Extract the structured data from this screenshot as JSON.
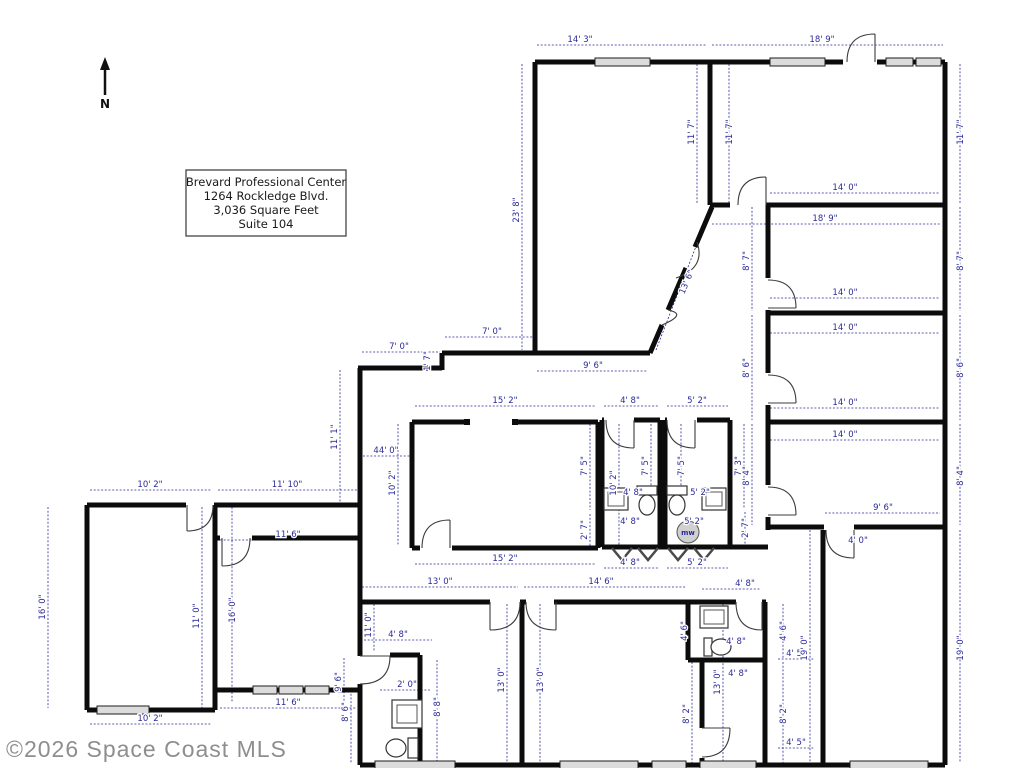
{
  "title_block": {
    "line1": "Brevard Professional Center",
    "line2": "1264 Rockledge Blvd.",
    "line3": "3,036 Square Feet",
    "line4": "Suite 104"
  },
  "north": {
    "label": "N"
  },
  "watermark": "©2026 Space Coast MLS",
  "fixtures": {
    "mw_label": "mw"
  },
  "colors": {
    "wall": "#0c0c0c",
    "dimension": "#2a2a9a",
    "watermark": "#8e8e8e",
    "window_fill": "#dcdcdc",
    "mw_fill": "#d0d0d0"
  },
  "dimensions": [
    {
      "t": "14' 3\"",
      "x": 580,
      "y": 42,
      "r": 0
    },
    {
      "t": "18' 9\"",
      "x": 822,
      "y": 42,
      "r": 0
    },
    {
      "t": "23' 8\"",
      "x": 519,
      "y": 210,
      "r": -90
    },
    {
      "t": "11' 7\"",
      "x": 694,
      "y": 132,
      "r": -90
    },
    {
      "t": "11' 7\"",
      "x": 732,
      "y": 132,
      "r": -90
    },
    {
      "t": "11' 7\"",
      "x": 963,
      "y": 132,
      "r": -90
    },
    {
      "t": "14' 0\"",
      "x": 845,
      "y": 190,
      "r": 0
    },
    {
      "t": "18' 9\"",
      "x": 825,
      "y": 221,
      "r": 0
    },
    {
      "t": "8' 7\"",
      "x": 749,
      "y": 261,
      "r": -90
    },
    {
      "t": "8' 7\"",
      "x": 963,
      "y": 261,
      "r": -90
    },
    {
      "t": "14' 0\"",
      "x": 845,
      "y": 295,
      "r": 0
    },
    {
      "t": "14' 0\"",
      "x": 845,
      "y": 330,
      "r": 0
    },
    {
      "t": "8' 6\"",
      "x": 749,
      "y": 368,
      "r": -90
    },
    {
      "t": "8' 6\"",
      "x": 963,
      "y": 368,
      "r": -90
    },
    {
      "t": "14' 0\"",
      "x": 845,
      "y": 405,
      "r": 0
    },
    {
      "t": "14' 0\"",
      "x": 845,
      "y": 437,
      "r": 0
    },
    {
      "t": "8' 4\"",
      "x": 749,
      "y": 476,
      "r": -90
    },
    {
      "t": "8' 4\"",
      "x": 963,
      "y": 476,
      "r": -90
    },
    {
      "t": "13' 6\"",
      "x": 689,
      "y": 283,
      "r": -67
    },
    {
      "t": "7' 0\"",
      "x": 399,
      "y": 349,
      "r": 0
    },
    {
      "t": "1' 7\"",
      "x": 430,
      "y": 361,
      "r": -90
    },
    {
      "t": "7' 0\"",
      "x": 492,
      "y": 334,
      "r": 0
    },
    {
      "t": "9' 6\"",
      "x": 593,
      "y": 368,
      "r": 0
    },
    {
      "t": "11' 1\"",
      "x": 337,
      "y": 437,
      "r": -90
    },
    {
      "t": "15' 2\"",
      "x": 505,
      "y": 403,
      "r": 0
    },
    {
      "t": "44' 0\"",
      "x": 386,
      "y": 453,
      "r": 0
    },
    {
      "t": "10' 2\"",
      "x": 395,
      "y": 483,
      "r": -90
    },
    {
      "t": "7' 5\"",
      "x": 587,
      "y": 466,
      "r": -90
    },
    {
      "t": "2' 7\"",
      "x": 587,
      "y": 530,
      "r": -90
    },
    {
      "t": "15' 2\"",
      "x": 505,
      "y": 561,
      "r": 0
    },
    {
      "t": "4' 8\"",
      "x": 630,
      "y": 403,
      "r": 0
    },
    {
      "t": "5' 2\"",
      "x": 697,
      "y": 403,
      "r": 0
    },
    {
      "t": "10' 2\"",
      "x": 616,
      "y": 483,
      "r": -90
    },
    {
      "t": "7' 5\"",
      "x": 648,
      "y": 466,
      "r": -90
    },
    {
      "t": "7' 5\"",
      "x": 684,
      "y": 466,
      "r": -90
    },
    {
      "t": "7' 3\"",
      "x": 741,
      "y": 466,
      "r": -90
    },
    {
      "t": "4' 8\"",
      "x": 633,
      "y": 495,
      "r": 0
    },
    {
      "t": "5' 2\"",
      "x": 700,
      "y": 495,
      "r": 0
    },
    {
      "t": "4' 8\"",
      "x": 630,
      "y": 524,
      "r": 0
    },
    {
      "t": "5' 2\"",
      "x": 694,
      "y": 524,
      "r": 0
    },
    {
      "t": "2' 7\"",
      "x": 748,
      "y": 528,
      "r": -90
    },
    {
      "t": "4' 8\"",
      "x": 630,
      "y": 565,
      "r": 0
    },
    {
      "t": "5' 2\"",
      "x": 697,
      "y": 565,
      "r": 0
    },
    {
      "t": "10' 2\"",
      "x": 150,
      "y": 487,
      "r": 0
    },
    {
      "t": "11' 10\"",
      "x": 287,
      "y": 487,
      "r": 0
    },
    {
      "t": "16' 0\"",
      "x": 45,
      "y": 607,
      "r": -90
    },
    {
      "t": "11' 0\"",
      "x": 199,
      "y": 616,
      "r": -90
    },
    {
      "t": "16' 0\"",
      "x": 235,
      "y": 610,
      "r": -90
    },
    {
      "t": "11' 6\"",
      "x": 288,
      "y": 537,
      "r": 0
    },
    {
      "t": "10' 2\"",
      "x": 150,
      "y": 721,
      "r": 0
    },
    {
      "t": "11' 6\"",
      "x": 288,
      "y": 705,
      "r": 0
    },
    {
      "t": "13' 0\"",
      "x": 440,
      "y": 584,
      "r": 0
    },
    {
      "t": "14' 6\"",
      "x": 601,
      "y": 584,
      "r": 0
    },
    {
      "t": "11' 0\"",
      "x": 371,
      "y": 625,
      "r": -90
    },
    {
      "t": "4' 8\"",
      "x": 398,
      "y": 637,
      "r": 0
    },
    {
      "t": "9' 6\"",
      "x": 341,
      "y": 682,
      "r": -90
    },
    {
      "t": "8' 6\"",
      "x": 348,
      "y": 712,
      "r": -90
    },
    {
      "t": "2' 0\"",
      "x": 407,
      "y": 687,
      "r": 0
    },
    {
      "t": "8' 8\"",
      "x": 440,
      "y": 707,
      "r": -90
    },
    {
      "t": "13' 0\"",
      "x": 504,
      "y": 680,
      "r": -90
    },
    {
      "t": "13' 0\"",
      "x": 543,
      "y": 680,
      "r": -90
    },
    {
      "t": "4' 8\"",
      "x": 745,
      "y": 586,
      "r": 0
    },
    {
      "t": "4' 6\"",
      "x": 687,
      "y": 631,
      "r": -90
    },
    {
      "t": "4' 6\"",
      "x": 786,
      "y": 631,
      "r": -90
    },
    {
      "t": "4' 8\"",
      "x": 736,
      "y": 644,
      "r": 0
    },
    {
      "t": "4' 8\"",
      "x": 738,
      "y": 676,
      "r": 0
    },
    {
      "t": "13' 0\"",
      "x": 720,
      "y": 682,
      "r": -90
    },
    {
      "t": "8' 2\"",
      "x": 689,
      "y": 714,
      "r": -90
    },
    {
      "t": "8' 2\"",
      "x": 786,
      "y": 714,
      "r": -90
    },
    {
      "t": "4' 5\"",
      "x": 796,
      "y": 656,
      "r": 0
    },
    {
      "t": "19' 0\"",
      "x": 807,
      "y": 648,
      "r": -90
    },
    {
      "t": "4' 5\"",
      "x": 796,
      "y": 745,
      "r": 0
    },
    {
      "t": "9' 6\"",
      "x": 883,
      "y": 510,
      "r": 0
    },
    {
      "t": "4' 0\"",
      "x": 858,
      "y": 543,
      "r": 0
    },
    {
      "t": "19' 0\"",
      "x": 963,
      "y": 648,
      "r": -90
    }
  ],
  "dim_lines": [
    [
      537,
      45,
      706,
      45
    ],
    [
      712,
      45,
      943,
      45
    ],
    [
      522,
      64,
      522,
      350
    ],
    [
      697,
      64,
      697,
      203
    ],
    [
      729,
      64,
      729,
      203
    ],
    [
      960,
      64,
      960,
      203
    ],
    [
      770,
      193,
      940,
      193
    ],
    [
      712,
      224,
      940,
      224
    ],
    [
      752,
      207,
      752,
      311
    ],
    [
      960,
      207,
      960,
      311
    ],
    [
      770,
      298,
      940,
      298
    ],
    [
      770,
      333,
      940,
      333
    ],
    [
      752,
      315,
      752,
      420
    ],
    [
      960,
      315,
      960,
      420
    ],
    [
      770,
      408,
      940,
      408
    ],
    [
      770,
      440,
      940,
      440
    ],
    [
      752,
      424,
      752,
      525
    ],
    [
      960,
      424,
      960,
      525
    ],
    [
      656,
      350,
      710,
      210
    ],
    [
      362,
      352,
      440,
      352
    ],
    [
      445,
      337,
      533,
      337
    ],
    [
      537,
      371,
      648,
      371
    ],
    [
      340,
      370,
      340,
      503
    ],
    [
      415,
      406,
      596,
      406
    ],
    [
      363,
      456,
      410,
      456
    ],
    [
      398,
      424,
      398,
      546
    ],
    [
      590,
      424,
      590,
      510
    ],
    [
      590,
      514,
      590,
      546
    ],
    [
      415,
      564,
      596,
      564
    ],
    [
      604,
      406,
      658,
      406
    ],
    [
      667,
      406,
      728,
      406
    ],
    [
      619,
      424,
      619,
      545
    ],
    [
      651,
      424,
      651,
      508
    ],
    [
      681,
      424,
      681,
      508
    ],
    [
      744,
      424,
      744,
      508
    ],
    [
      745,
      512,
      745,
      545
    ],
    [
      604,
      568,
      658,
      568
    ],
    [
      667,
      568,
      728,
      568
    ],
    [
      90,
      490,
      212,
      490
    ],
    [
      218,
      490,
      358,
      490
    ],
    [
      48,
      507,
      48,
      708
    ],
    [
      202,
      507,
      202,
      708
    ],
    [
      232,
      507,
      232,
      702
    ],
    [
      220,
      540,
      356,
      540
    ],
    [
      90,
      724,
      212,
      724
    ],
    [
      220,
      708,
      356,
      708
    ],
    [
      362,
      587,
      518,
      587
    ],
    [
      524,
      587,
      686,
      587
    ],
    [
      374,
      604,
      374,
      652
    ],
    [
      507,
      604,
      507,
      763
    ],
    [
      540,
      604,
      540,
      763
    ],
    [
      344,
      658,
      344,
      705
    ],
    [
      351,
      690,
      351,
      763
    ],
    [
      364,
      640,
      432,
      640
    ],
    [
      437,
      660,
      437,
      763
    ],
    [
      690,
      604,
      690,
      658
    ],
    [
      783,
      604,
      783,
      658
    ],
    [
      692,
      662,
      692,
      763
    ],
    [
      783,
      662,
      783,
      763
    ],
    [
      723,
      604,
      723,
      763
    ],
    [
      825,
      513,
      940,
      513
    ],
    [
      810,
      530,
      810,
      763
    ],
    [
      960,
      530,
      960,
      763
    ],
    [
      778,
      659,
      814,
      659
    ],
    [
      778,
      748,
      814,
      748
    ],
    [
      702,
      589,
      760,
      589
    ],
    [
      380,
      690,
      430,
      690
    ]
  ]
}
